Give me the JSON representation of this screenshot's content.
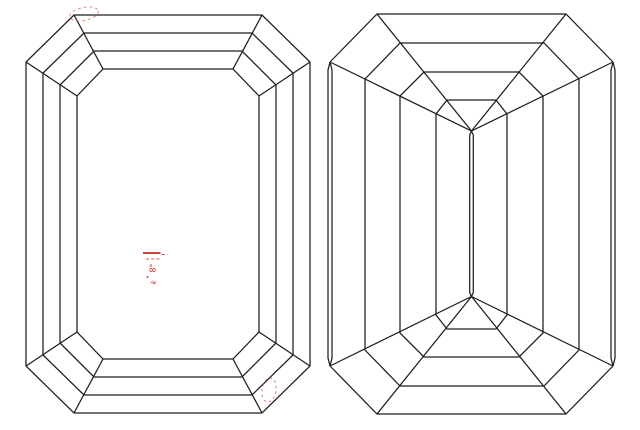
{
  "page": {
    "background": "#ffffff"
  },
  "style": {
    "line_color": "#1e1e1e",
    "line_width": 1.25
  },
  "crown_view": {
    "rings": [
      {
        "left": 26,
        "right": 310,
        "top": 15,
        "bottom": 413,
        "corner_dx": 48,
        "corner_dy": 47
      },
      {
        "left": 43,
        "right": 293,
        "top": 33,
        "bottom": 395,
        "corner_dx": 41,
        "corner_dy": 40
      },
      {
        "left": 60,
        "right": 276,
        "top": 51,
        "bottom": 377,
        "corner_dx": 34,
        "corner_dy": 34
      },
      {
        "left": 77,
        "right": 259,
        "top": 69,
        "bottom": 359,
        "corner_dx": 26,
        "corner_dy": 27
      }
    ]
  },
  "pavilion_view": {
    "rings": [
      {
        "left": 330,
        "right": 613,
        "top": 14,
        "bottom": 414,
        "corner_dx": 47,
        "corner_dy": 48
      },
      {
        "left": 365,
        "right": 579,
        "top": 43,
        "bottom": 386,
        "corner_dx": 35,
        "corner_dy": 36
      },
      {
        "left": 400,
        "right": 543,
        "top": 72,
        "bottom": 357,
        "corner_dx": 24,
        "corner_dy": 24
      },
      {
        "left": 436,
        "right": 507,
        "top": 100,
        "bottom": 329,
        "corner_dx": 11,
        "corner_dy": 14
      }
    ],
    "apex_top": {
      "x": 471.5,
      "y": 131
    },
    "apex_bottom": {
      "x": 471.5,
      "y": 296.5
    },
    "keel_half_width": 1.8,
    "keel_inset": 4,
    "girdle_sliver_offset": 2,
    "girdle_sliver_inset": 8
  },
  "annotations": {
    "accent_color": "#c3281a",
    "ellipses": [
      {
        "name": "dashed-ellipse-top-left",
        "cx": 84,
        "cy": 14,
        "rx": 14.5,
        "ry": 6.5,
        "rotate": -12,
        "dash": "2.8 3",
        "width": 0.9,
        "opacity": 0.75,
        "color": "#c8523e"
      },
      {
        "name": "dashed-ellipse-bottom-right",
        "cx": 269,
        "cy": 390,
        "rx": 7,
        "ry": 12,
        "rotate": 9,
        "dash": "2.6 2.9",
        "width": 0.9,
        "opacity": 0.8,
        "color": "#c8523e"
      }
    ],
    "lines": [
      {
        "name": "solid-tick-line",
        "x1": 143,
        "y1": 253,
        "x2": 160.5,
        "y2": 253,
        "width": 1.7,
        "opacity": 1,
        "color": "#c3281a",
        "dash": ""
      },
      {
        "name": "short-dash-line",
        "x1": 161.5,
        "y1": 254.5,
        "x2": 167.5,
        "y2": 254.5,
        "width": 1,
        "opacity": 0.9,
        "color": "#c84a38",
        "dash": "3.4 2"
      },
      {
        "name": "dashed-tick-line",
        "x1": 146,
        "y1": 259,
        "x2": 161.5,
        "y2": 259,
        "width": 1,
        "opacity": 0.9,
        "color": "#c84a38",
        "dash": "3 2.2"
      }
    ],
    "dots": [
      {
        "name": "tiny-dot",
        "x": 147.5,
        "y": 277,
        "r": 1,
        "color": "#c84a38"
      }
    ],
    "texts": [
      {
        "name": "tiny-rotated-label",
        "label": "8°",
        "x": 155.5,
        "y": 268,
        "rotate": -90,
        "size": 8,
        "color": "#c3281a"
      },
      {
        "name": "tiny-rotated-label-2",
        "label": "k",
        "x": 156,
        "y": 283,
        "rotate": -70,
        "size": 7,
        "color": "#c3281a"
      }
    ]
  }
}
